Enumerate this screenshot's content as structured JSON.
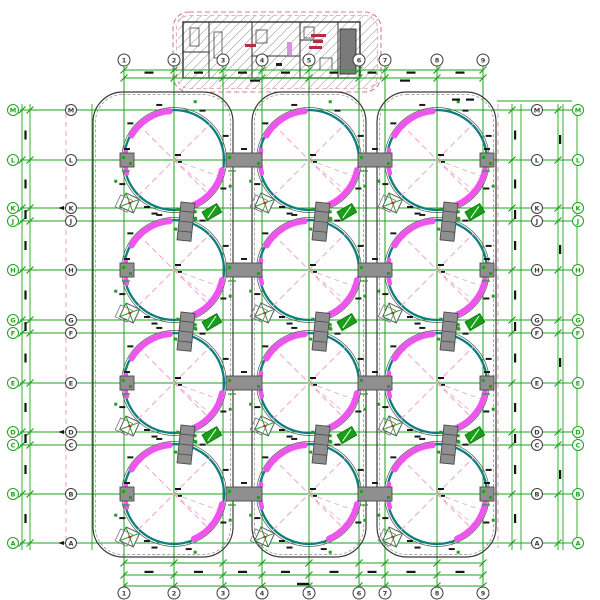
{
  "drawing": {
    "type": "cad-tank-farm-plan",
    "axes": {
      "top_labels": [
        "1",
        "2",
        "3",
        "4",
        "5",
        "6",
        "7",
        "8",
        "9"
      ],
      "bottom_labels": [
        "1",
        "2",
        "3",
        "4",
        "5",
        "6",
        "7",
        "8",
        "9"
      ],
      "left_labels": [
        "M",
        "L",
        "K",
        "J",
        "H",
        "G",
        "F",
        "E",
        "D",
        "C",
        "B",
        "A"
      ],
      "right_labels": [
        "M",
        "L",
        "K",
        "J",
        "H",
        "G",
        "F",
        "E",
        "D",
        "C",
        "B",
        "A"
      ]
    },
    "tanks": {
      "rows": 4,
      "cols": 3,
      "count": 12
    },
    "colors": {
      "grid_green": "#1ea21e",
      "grid_pink": "#f2a9bd",
      "diag_pink": "#f0a2c8",
      "tank_teal": "#0d7e7e",
      "highlight_magenta": "#ee55ee",
      "block_gray": "#8f8f8f",
      "outline_black": "#2f2f2f",
      "building_dash_pink": "#e07890",
      "hatch_gray": "#b5b5b5",
      "red_label": "#b03040",
      "bubble_dark": "#3d3d3d"
    }
  }
}
